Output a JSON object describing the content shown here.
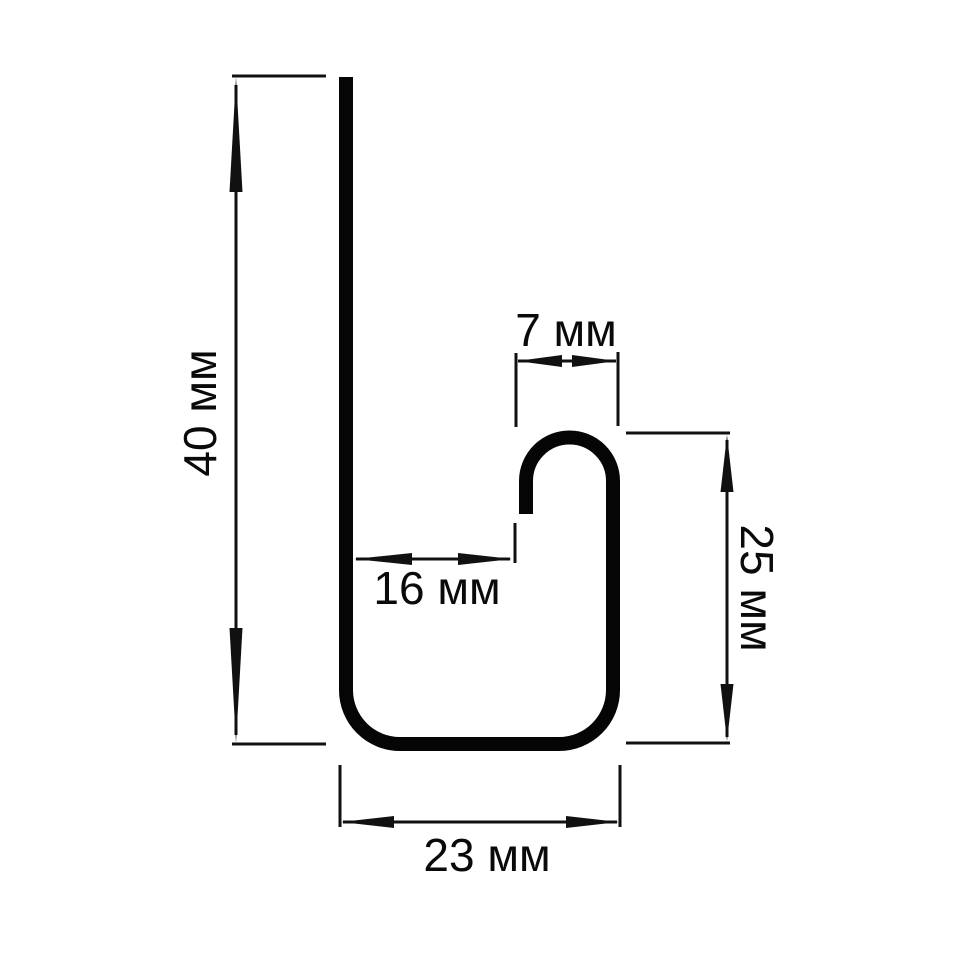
{
  "drawing": {
    "unit": "мм",
    "dimensions": {
      "overall_height": {
        "label": "40 мм",
        "value": 40
      },
      "hook_width": {
        "label": "7 мм",
        "value": 7
      },
      "opening_depth": {
        "label": "16 мм",
        "value": 16
      },
      "right_side_height": {
        "label": "25 мм",
        "value": 25
      },
      "base_width": {
        "label": "23 мм",
        "value": 23
      }
    },
    "colors": {
      "profile_line": "#050505",
      "dimension_line": "#111111",
      "background": "#ffffff"
    }
  }
}
